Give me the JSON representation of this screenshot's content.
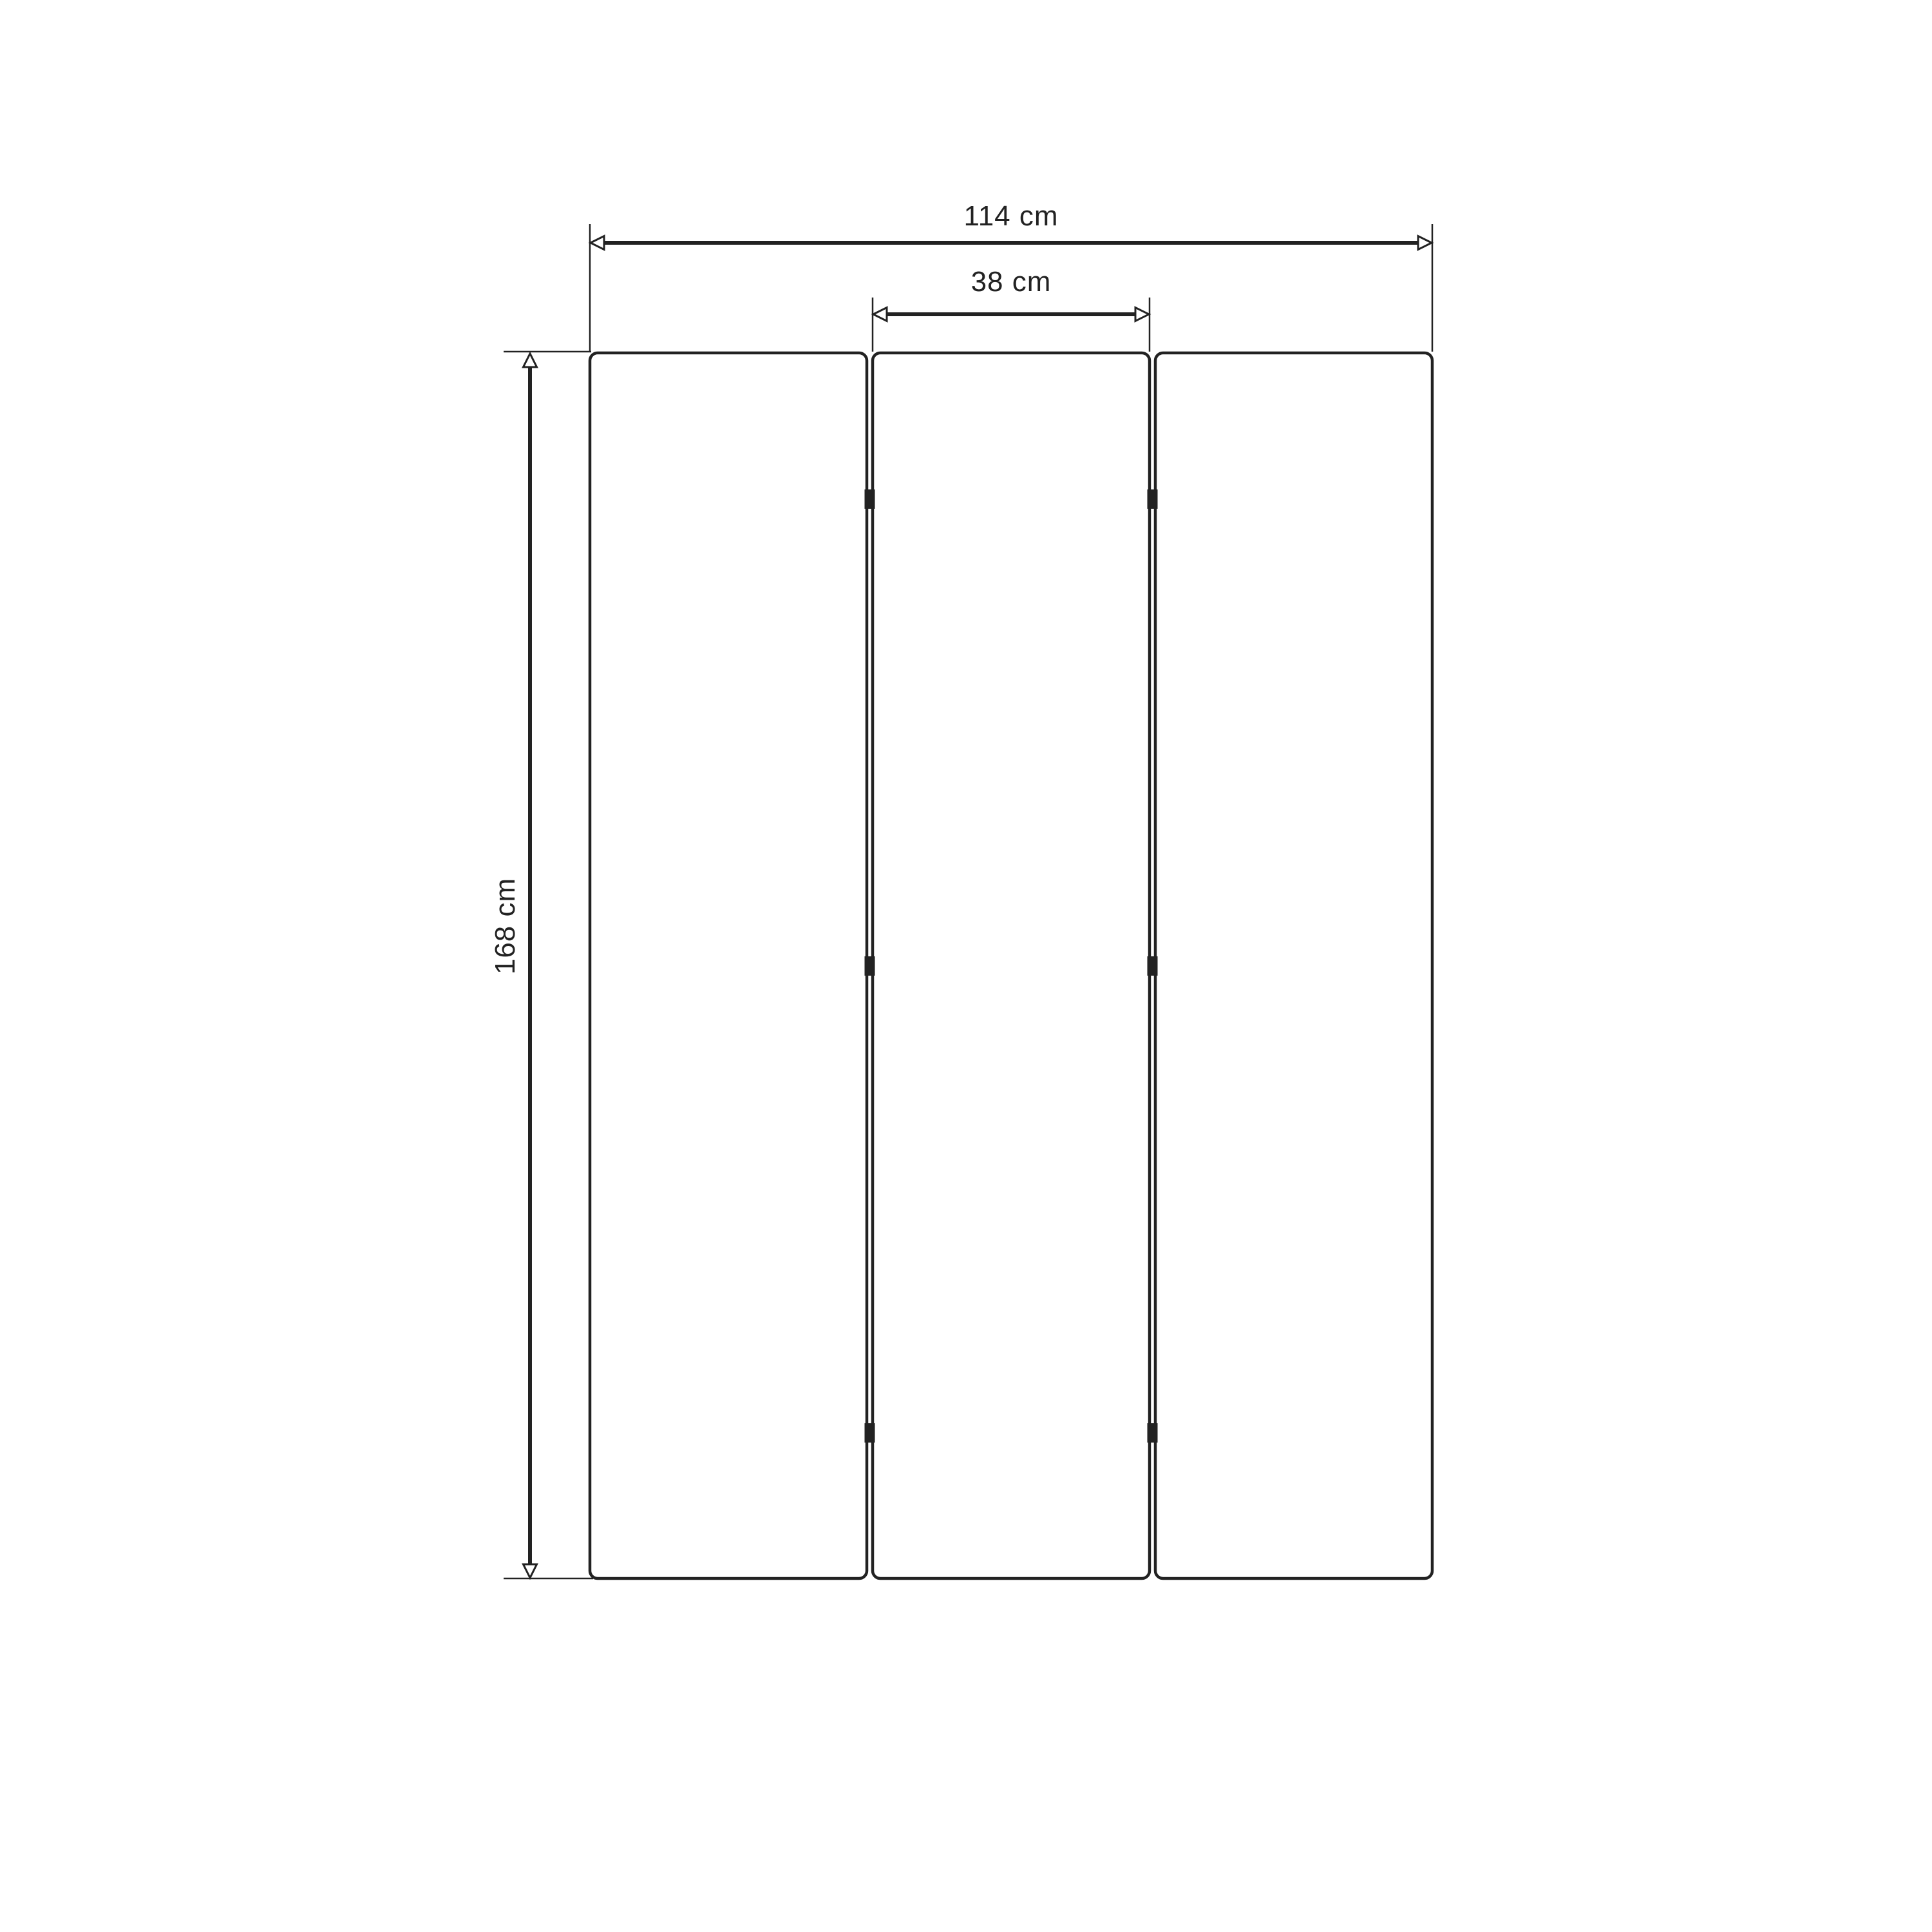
{
  "diagram": {
    "kind": "dimension-drawing",
    "subject": "three-panel-screen-front-view",
    "labels": {
      "total_width": "114 cm",
      "middle_panel_width": "38 cm",
      "height": "168 cm"
    },
    "values": {
      "total_width_cm": 114,
      "middle_panel_width_cm": 38,
      "height_cm": 168
    },
    "panel_count": 3,
    "hinge_marks_per_gap": 3,
    "colors": {
      "line": "#222222",
      "background": "#ffffff",
      "hinge": "#222222"
    }
  }
}
